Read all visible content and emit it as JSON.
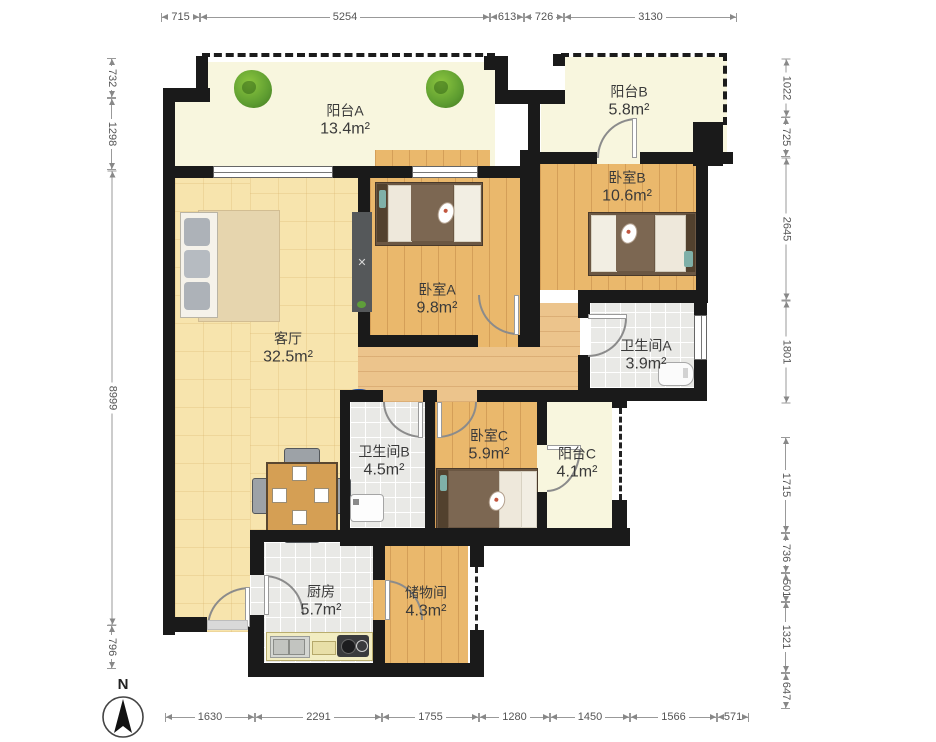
{
  "compass": {
    "label": "N"
  },
  "rooms": {
    "balcony_a": {
      "name": "阳台A",
      "area": "13.4m²"
    },
    "balcony_b": {
      "name": "阳台B",
      "area": "5.8m²"
    },
    "bedroom_a": {
      "name": "卧室A",
      "area": "9.8m²"
    },
    "bedroom_b": {
      "name": "卧室B",
      "area": "10.6m²"
    },
    "bedroom_c": {
      "name": "卧室C",
      "area": "5.9m²"
    },
    "living_room": {
      "name": "客厅",
      "area": "32.5m²"
    },
    "bathroom_a": {
      "name": "卫生间A",
      "area": "3.9m²"
    },
    "bathroom_b": {
      "name": "卫生间B",
      "area": "4.5m²"
    },
    "balcony_c": {
      "name": "阳台C",
      "area": "4.1m²"
    },
    "kitchen": {
      "name": "厨房",
      "area": "5.7m²"
    },
    "storage": {
      "name": "储物间",
      "area": "4.3m²"
    }
  },
  "dimensions": {
    "top": [
      "715",
      "5254",
      "613",
      "726",
      "3130"
    ],
    "bottom": [
      "1630",
      "2291",
      "1755",
      "1280",
      "1450",
      "1566",
      "571"
    ],
    "left": [
      "732",
      "1298",
      "8999",
      "796"
    ],
    "right": [
      "1022",
      "725",
      "2645",
      "1801",
      "1715",
      "736",
      "501",
      "1321",
      "647"
    ]
  },
  "colors": {
    "wall": "#1a1a1a",
    "wood_floor": "#eab86c",
    "living_floor": "#f7e4ad",
    "balcony_floor": "#f8f6de",
    "tile_floor": "#e9e9e6",
    "plant_green": "#5d9c30",
    "sink_blue": "#2f66c9"
  }
}
